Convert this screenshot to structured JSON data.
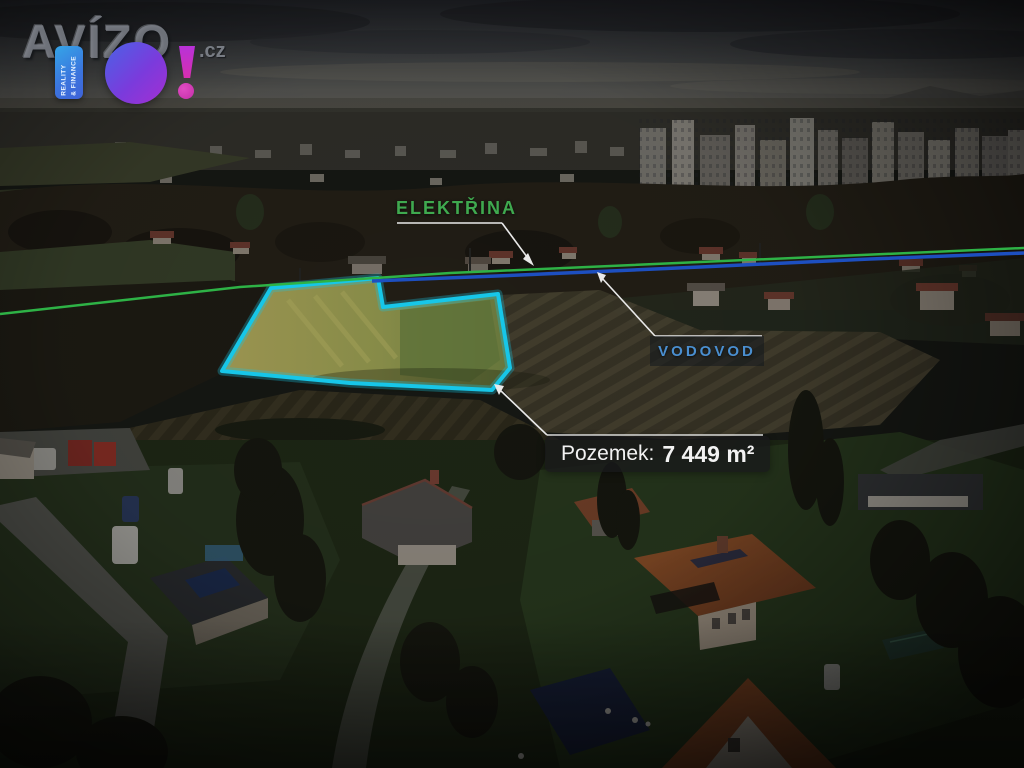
{
  "logo": {
    "brand": "AVÍZO",
    "tld": ".cz",
    "bo": "BO!",
    "b_tagline_line1": "REALITY",
    "b_tagline_line2": "& FINANCE",
    "colors": {
      "b_block": "#3b74dd",
      "o_circle": "#8a35d8",
      "exclamation": "#d62fae",
      "brand_text": "#80848c"
    }
  },
  "annotations": {
    "electricity": {
      "label": "ELEKTŘINA",
      "color": "#3fa94f"
    },
    "water": {
      "label": "VODOVOD",
      "color": "#4a8fd0"
    },
    "parcel": {
      "label": "Pozemek:",
      "area": "7 449 m²"
    }
  },
  "parcel": {
    "outline_color": "#17c6e8"
  },
  "utility_lines": {
    "electricity_color": "#2eb246",
    "water_color": "#1d4fc0"
  }
}
